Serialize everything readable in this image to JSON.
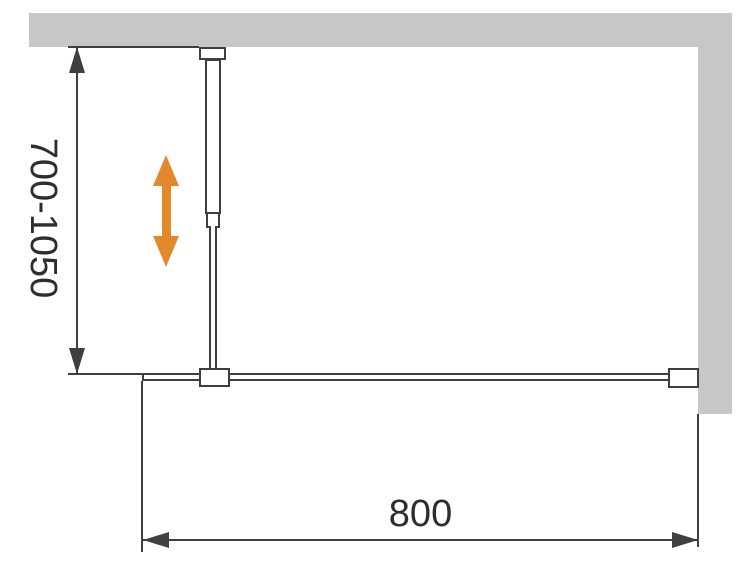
{
  "diagram": {
    "title": "shower-screen-plan-view-dimension-drawing",
    "labels": {
      "support_bar_range": "700-1050",
      "glass_width": "800"
    },
    "icons": {
      "adjust_arrow": "double-headed-vertical-arrow",
      "dimension_arrows": "filled-triangle-arrowheads"
    }
  },
  "colors": {
    "background": "#ffffff",
    "wall": "#c7c7c7",
    "line": "#3f3f3f",
    "accent": "#e2892b",
    "text": "#2d2d2d"
  }
}
